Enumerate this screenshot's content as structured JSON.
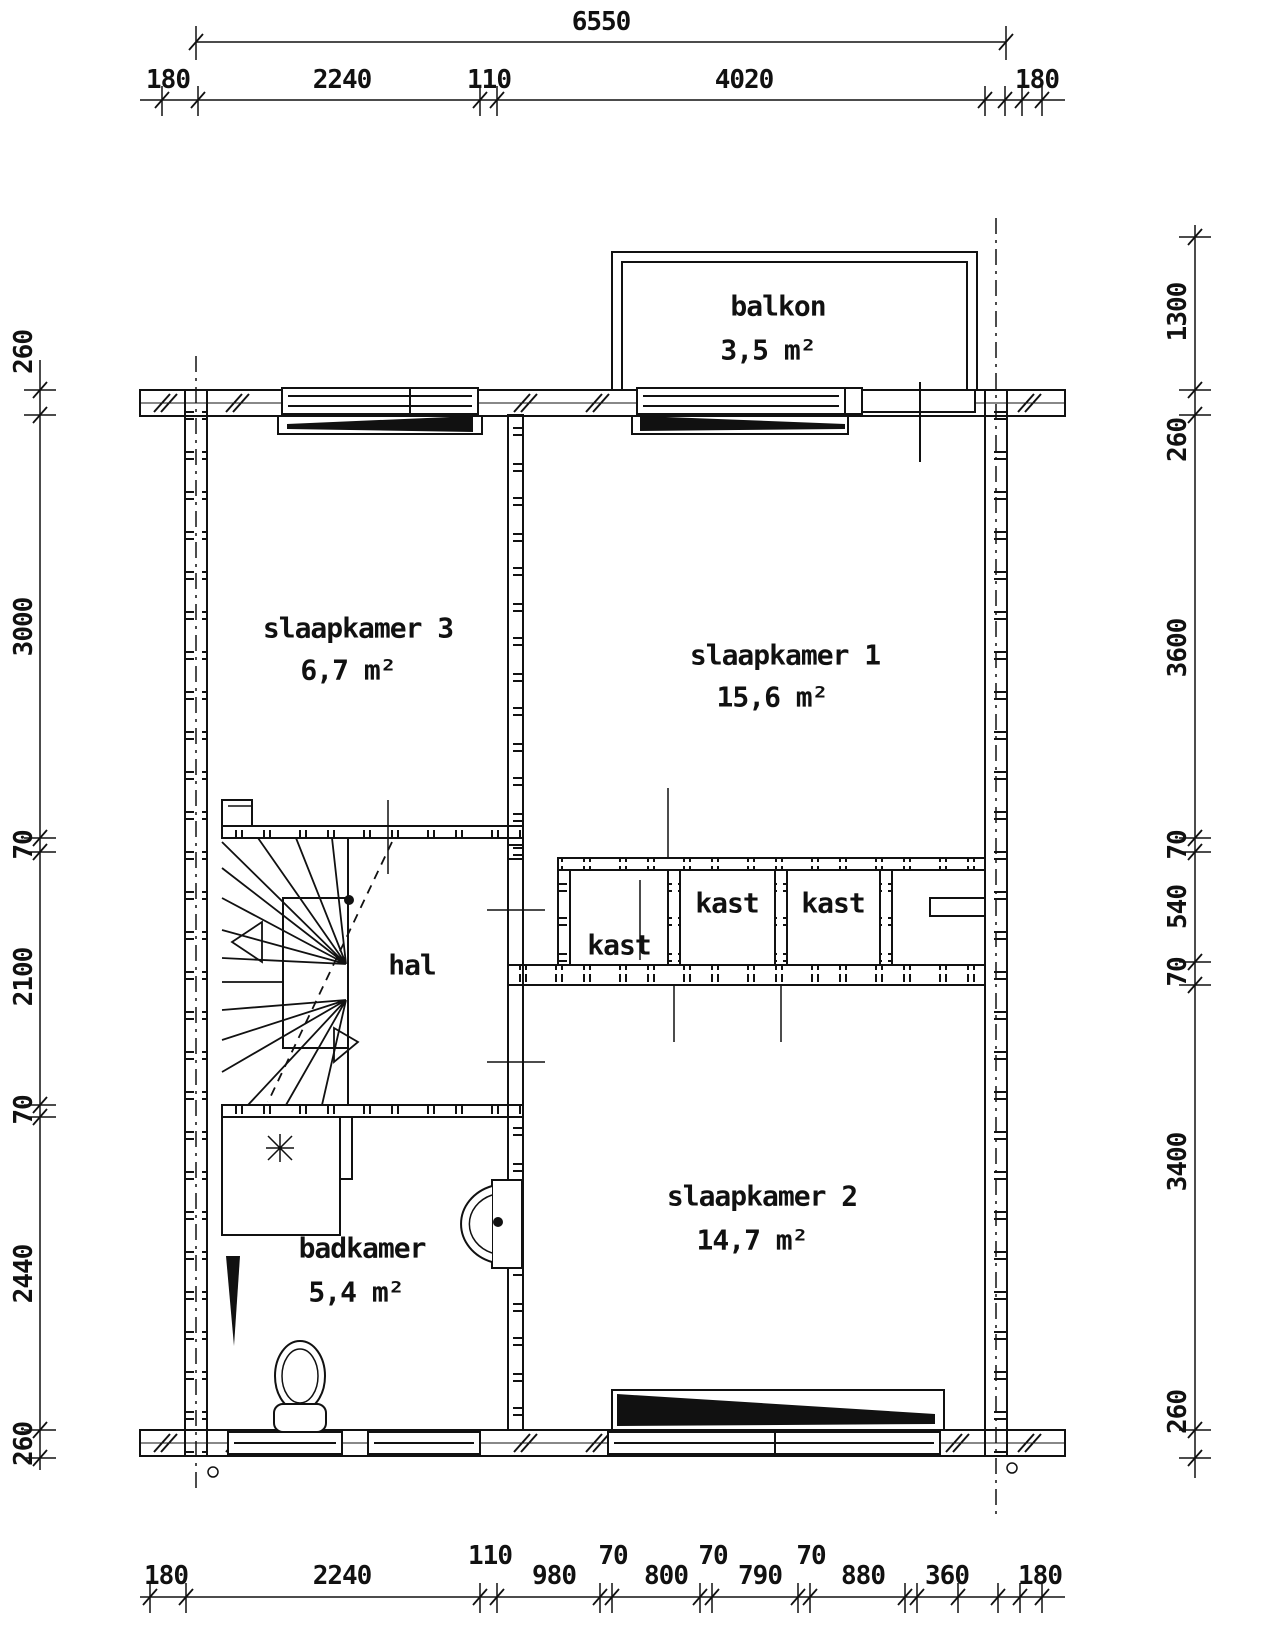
{
  "drawing": {
    "background_color": "#ffffff",
    "line_color": "#111111"
  },
  "rooms": {
    "balkon": {
      "name": "balkon",
      "area": "3,5 m²"
    },
    "slaapkamer3": {
      "name": "slaapkamer 3",
      "area": "6,7 m²"
    },
    "slaapkamer1": {
      "name": "slaapkamer 1",
      "area": "15,6 m²"
    },
    "hal": {
      "name": "hal"
    },
    "kast_left": {
      "name": "kast"
    },
    "kast_middle": {
      "name": "kast"
    },
    "kast_right": {
      "name": "kast"
    },
    "slaapkamer2": {
      "name": "slaapkamer 2",
      "area": "14,7 m²"
    },
    "badkamer": {
      "name": "badkamer",
      "area": "5,4 m²"
    }
  },
  "dimensions": {
    "top": {
      "overall": "6550",
      "segments": [
        "180",
        "2240",
        "110",
        "4020",
        "180"
      ]
    },
    "bottom": {
      "segments": [
        "180",
        "2240",
        "110",
        "980",
        "70",
        "800",
        "70",
        "790",
        "70",
        "880",
        "360",
        "180"
      ]
    },
    "left": {
      "segments": [
        "260",
        "3000",
        "70",
        "2100",
        "70",
        "2440",
        "260"
      ]
    },
    "right": {
      "segments": [
        "1300",
        "260",
        "3600",
        "70",
        "540",
        "70",
        "3400",
        "260"
      ]
    }
  }
}
